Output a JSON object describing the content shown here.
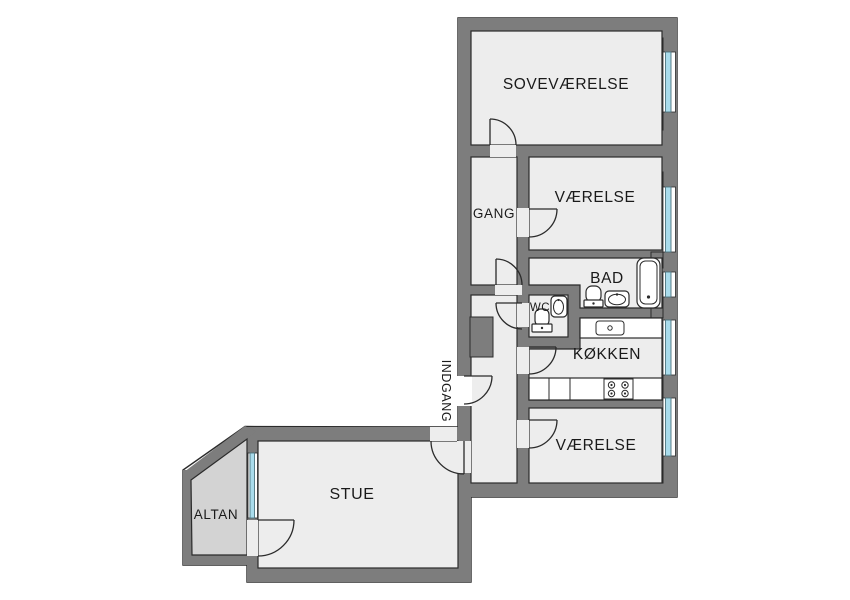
{
  "title": "Apartment floor plan (Danish)",
  "colors": {
    "wall": "#7d7d7d",
    "outline": "#2b2b2b",
    "floor": "#ededed",
    "balcony": "#d3d3d3",
    "glass": "#a9dcec",
    "glass_edge": "#4e747f",
    "text": "#1a1a1a",
    "background": "#ffffff"
  },
  "rooms": [
    {
      "id": "sovevaerelse",
      "label": "SOVEVÆRELSE"
    },
    {
      "id": "vaerelse-top",
      "label": "VÆRELSE"
    },
    {
      "id": "gang",
      "label": "GANG"
    },
    {
      "id": "bad",
      "label": "BAD"
    },
    {
      "id": "wc",
      "label": "WC"
    },
    {
      "id": "koekken",
      "label": "KØKKEN"
    },
    {
      "id": "vaerelse-bottom",
      "label": "VÆRELSE"
    },
    {
      "id": "stue",
      "label": "STUE"
    },
    {
      "id": "altan",
      "label": "ALTAN"
    },
    {
      "id": "indgang",
      "label": "INDGANG"
    }
  ],
  "fixtures": [
    {
      "name": "bathtub",
      "room": "BAD"
    },
    {
      "name": "toilet",
      "room": "BAD"
    },
    {
      "name": "washbasin",
      "room": "BAD"
    },
    {
      "name": "toilet",
      "room": "WC"
    },
    {
      "name": "washbasin",
      "room": "WC"
    },
    {
      "name": "kitchen-sink-counter",
      "room": "KØKKEN"
    },
    {
      "name": "kitchen-counter-with-stove",
      "room": "KØKKEN"
    }
  ],
  "window_count": 6,
  "door_count": 9
}
